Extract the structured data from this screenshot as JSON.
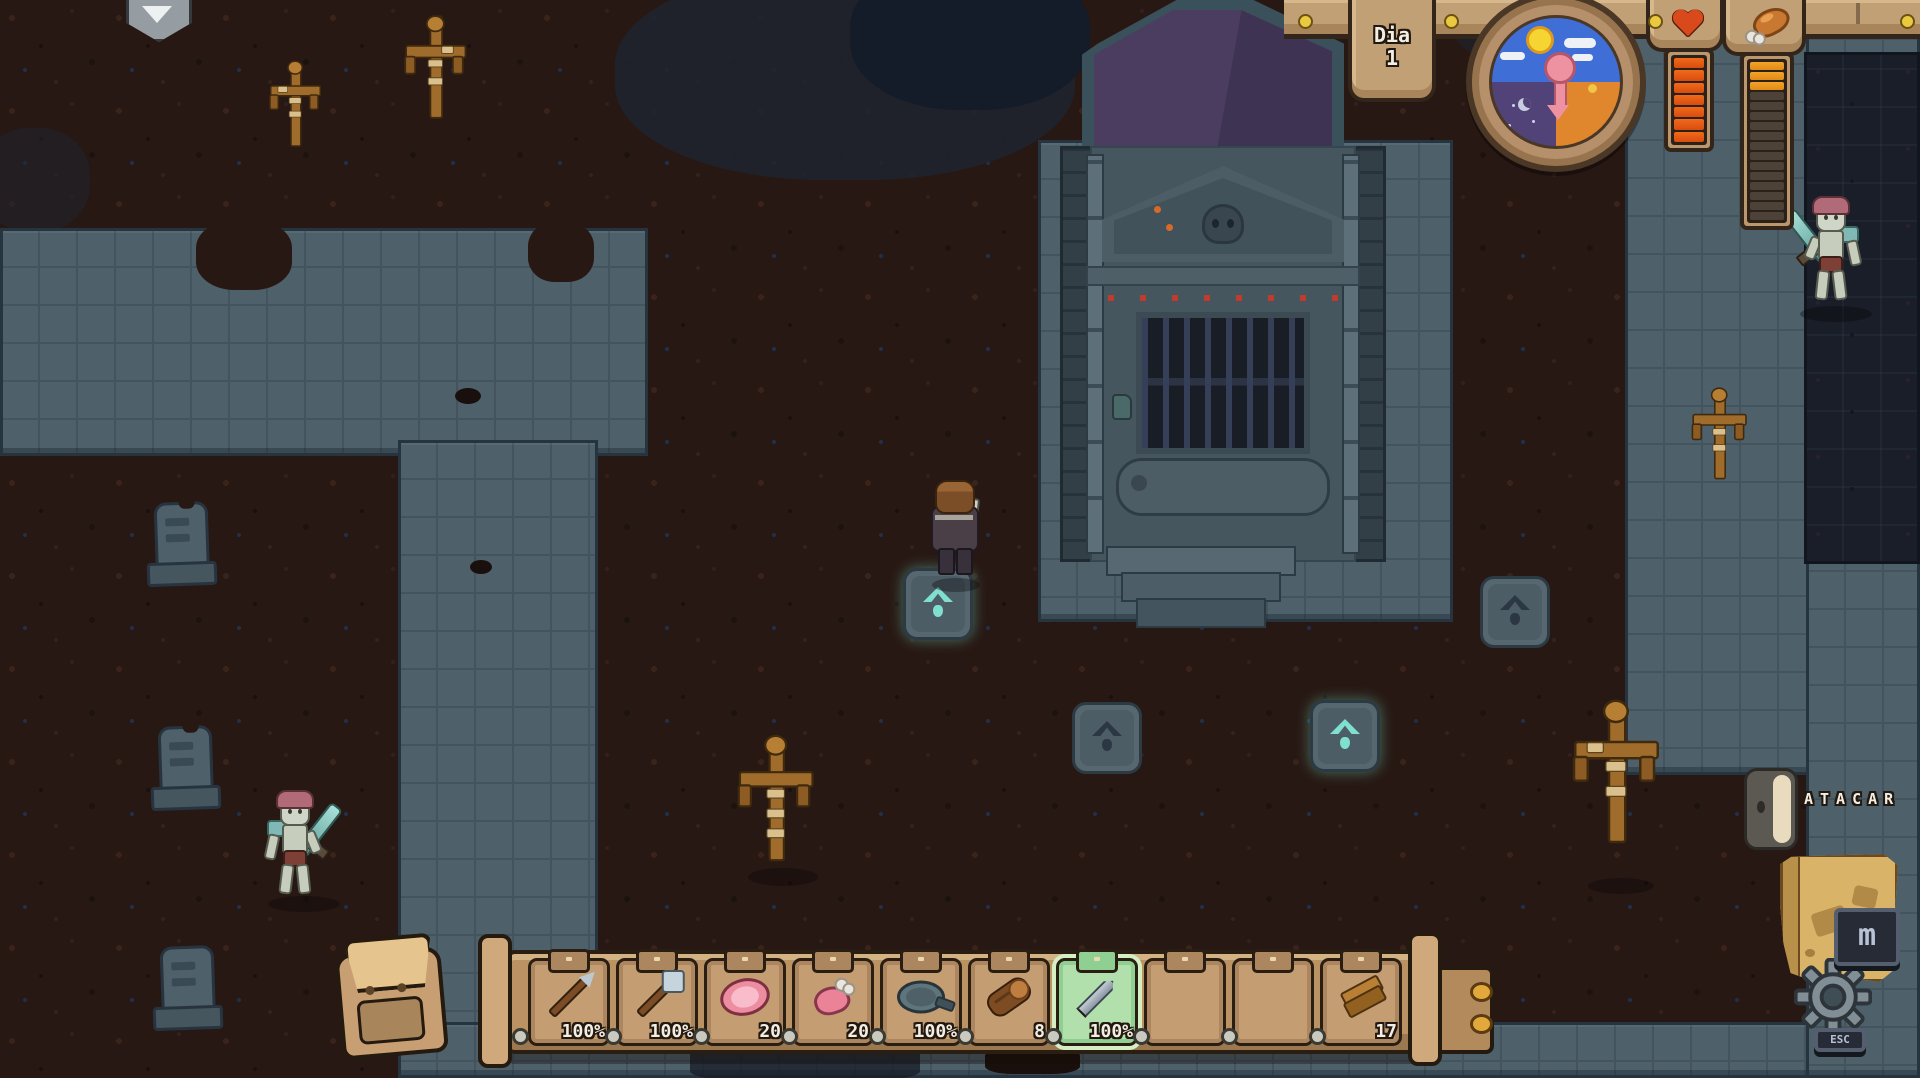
{
  "hud": {
    "day_plaque": {
      "label": "Dia",
      "value": "1"
    },
    "clock": {
      "day_color": "#3f6fd6",
      "night_color": "#514278",
      "dusk_color": "#e0862c",
      "pointer_color": "#ee92a2"
    },
    "health": {
      "icon": "heart-icon",
      "color": "#d8491c",
      "segments_total": 7,
      "segments_filled": 7
    },
    "hunger": {
      "icon": "drumstick-icon",
      "color": "#e8941f",
      "segments_total": 16,
      "segments_filled": 3
    }
  },
  "hotbar": {
    "selected_index": 6,
    "selected_color": "#b2e0ac",
    "slots": [
      {
        "item": "spear",
        "value": "100%"
      },
      {
        "item": "shovel",
        "value": "100%"
      },
      {
        "item": "raw-meat",
        "value": "20"
      },
      {
        "item": "raw-drumstick",
        "value": "20"
      },
      {
        "item": "frying-pan",
        "value": "100%"
      },
      {
        "item": "wood-log",
        "value": "8"
      },
      {
        "item": "sword",
        "value": "100%"
      },
      {
        "item": "empty",
        "value": ""
      },
      {
        "item": "empty",
        "value": ""
      },
      {
        "item": "wood-planks",
        "value": "17"
      }
    ]
  },
  "action_prompt": {
    "icon": "mouse-button-icon",
    "label": "ATACAR"
  },
  "map_button": {
    "icon": "map-scroll-icon",
    "key_badge": "m"
  },
  "settings_button": {
    "icon": "gear-icon",
    "key_badge": "ESC"
  },
  "world": {
    "sign": "down-arrow-sign",
    "pressure_plates_active": 2,
    "pressure_plates_inactive": 2,
    "skeletons": 2,
    "gravestones": 3,
    "wooden_crosses": 5
  },
  "colors": {
    "stone_path": "#4e616b",
    "dirt": "#281813",
    "night_plot": "#191e29",
    "ui_wood": "#c2a076",
    "active_glyph": "#7fe0d0"
  }
}
